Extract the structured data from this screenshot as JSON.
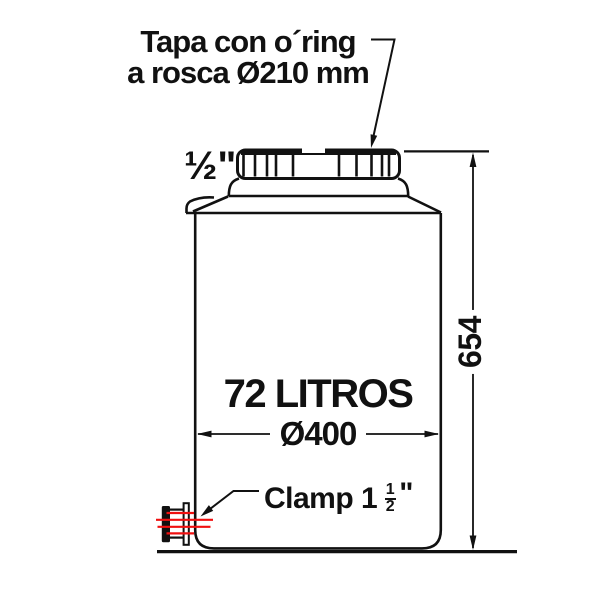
{
  "drawing": {
    "title": {
      "line1": "Tapa con o´ring",
      "line2": "a rosca Ø210 mm"
    },
    "labels": {
      "top_port": "½\"",
      "capacity": "72 LITROS",
      "diameter": "Ø400",
      "height": "654",
      "clamp": {
        "prefix": "Clamp 1",
        "numerator": "1",
        "denominator": "2",
        "unit": "\""
      }
    },
    "colors": {
      "line": "#111111",
      "accent_red": "#f01010",
      "background": "#ffffff"
    }
  }
}
